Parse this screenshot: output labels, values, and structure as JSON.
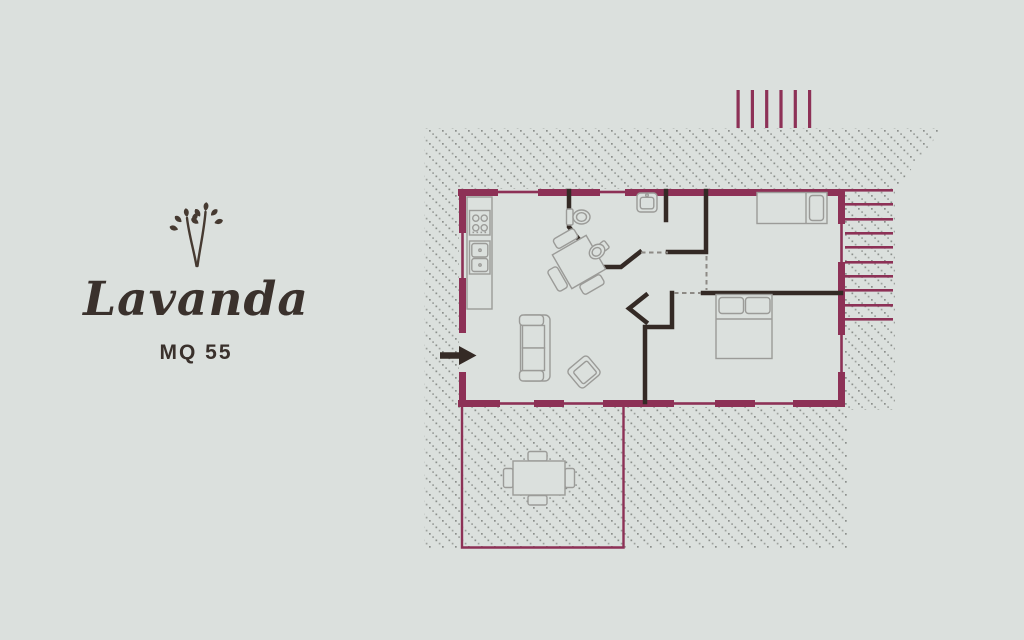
{
  "window": {
    "width": 1024,
    "height": 640
  },
  "panel": {
    "icon": "lavender-sprig-icon",
    "title": "Lavanda",
    "area_label": "MQ 55"
  },
  "floorplan": {
    "type": "apartment-floor-plan",
    "furniture": [
      "kitchen-counter",
      "stove",
      "kitchen-sink",
      "dining-table",
      "dining-chairs",
      "sofa",
      "armchair",
      "toilet",
      "bidet",
      "washbasin",
      "single-bed",
      "double-bed",
      "terrace-table",
      "terrace-chairs"
    ],
    "features": [
      "entrance-arrow",
      "terrace",
      "external-stairs",
      "pergola-lines",
      "hatched-surroundings",
      "window-openings",
      "door-openings"
    ]
  },
  "colors": {
    "background": "#dbe0dd",
    "wall_accent": "#8d3156",
    "interior_wall": "#342a25",
    "furniture_line": "#9b9b98",
    "hatch_dot": "#9da19d",
    "hatch_dot_dark": "#8b8f8b",
    "door_dash": "#8d8a85",
    "text": "#3a312c"
  }
}
